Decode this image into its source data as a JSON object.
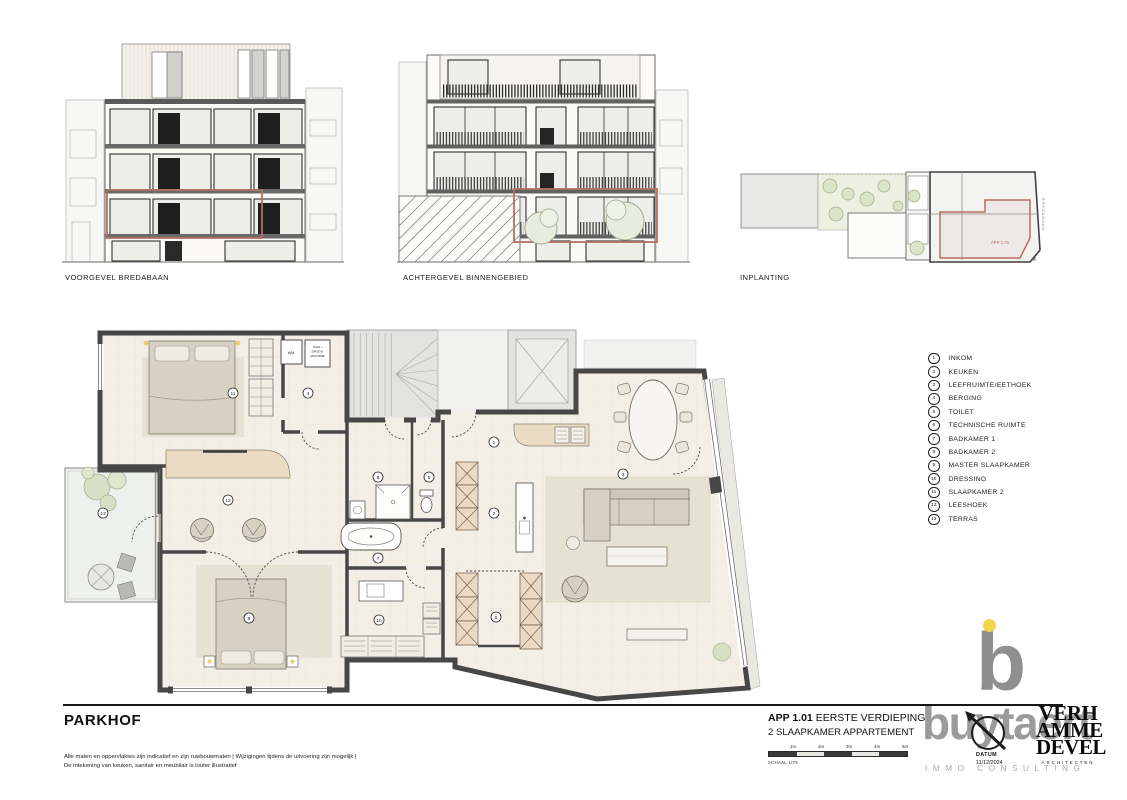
{
  "elevations": [
    {
      "caption": "VOORGEVEL BREDABAAN"
    },
    {
      "caption": "ACHTERGEVEL BINNENGEBIED"
    },
    {
      "caption": "INPLANTING",
      "unit_label": "APP 1.01",
      "street_label": "BREDABAAN"
    }
  ],
  "legend": {
    "items": [
      {
        "num": "1",
        "label": "INKOM"
      },
      {
        "num": "2",
        "label": "KEUKEN"
      },
      {
        "num": "3",
        "label": "LEEFRUIMTE/EETHOEK"
      },
      {
        "num": "4",
        "label": "BERGING"
      },
      {
        "num": "5",
        "label": "TOILET"
      },
      {
        "num": "6",
        "label": "TECHNISCHE RUIMTE"
      },
      {
        "num": "7",
        "label": "BADKAMER 1"
      },
      {
        "num": "8",
        "label": "BADKAMER 2"
      },
      {
        "num": "9",
        "label": "MASTER SLAAPKAMER"
      },
      {
        "num": "10",
        "label": "DRESSING"
      },
      {
        "num": "11",
        "label": "SLAAPKAMER 2"
      },
      {
        "num": "12",
        "label": "LEESHOEK"
      },
      {
        "num": "13",
        "label": "TERRAS"
      }
    ]
  },
  "plan": {
    "markers": [
      {
        "num": "1",
        "x": 494,
        "y": 442
      },
      {
        "num": "2",
        "x": 494,
        "y": 513
      },
      {
        "num": "3",
        "x": 623,
        "y": 474
      },
      {
        "num": "4",
        "x": 308,
        "y": 393
      },
      {
        "num": "5",
        "x": 429,
        "y": 477
      },
      {
        "num": "6",
        "x": 496,
        "y": 617
      },
      {
        "num": "7",
        "x": 378,
        "y": 558
      },
      {
        "num": "8",
        "x": 378,
        "y": 477
      },
      {
        "num": "9",
        "x": 249,
        "y": 618
      },
      {
        "num": "10",
        "x": 379,
        "y": 620
      },
      {
        "num": "11",
        "x": 233,
        "y": 393
      },
      {
        "num": "12",
        "x": 228,
        "y": 500
      },
      {
        "num": "13",
        "x": 103,
        "y": 513
      }
    ],
    "labels": {
      "wm": "WM.",
      "wasdroog_l1": "WAS /",
      "wasdroog_l2": "DROOG",
      "wasdroog_l3": "MACHINE"
    }
  },
  "footer": {
    "project_name": "PARKHOF",
    "disclaimer_line1": "Alle maten en oppervlaktes zijn indicatief en zijn ruwbouwmaten | Wijzigingen tijdens de uitvoering zijn mogelijk |",
    "disclaimer_line2": "De intekening van keuken, sanitair en meubilair is louter illustratief",
    "unit_code": "APP 1.01",
    "unit_floor": "EERSTE VERDIEPING",
    "unit_type": "2 SLAAPKAMER APPARTEMENT",
    "scale_ticks": [
      "1m",
      "2m",
      "3m",
      "4m",
      "5m"
    ],
    "scale_label": "SCHAAL 1/75",
    "datum_label": "DATUM",
    "datum_value": "11/12/2024"
  },
  "logos": {
    "buytaert_text": "buytaert",
    "buytaert_sub": "IMMO CONSULTING",
    "architect_lines": [
      "VERH",
      "AMME",
      "DEVEL"
    ],
    "architect_sub": "ARCHITECTEN"
  },
  "colors": {
    "accent_red": "#b5705f",
    "wall": "#474747",
    "floor": "#f4efe6",
    "cabinet": "#ecd9c4",
    "logo_gray": "#9b9b9b",
    "logo_yellow": "#f2d44c"
  }
}
